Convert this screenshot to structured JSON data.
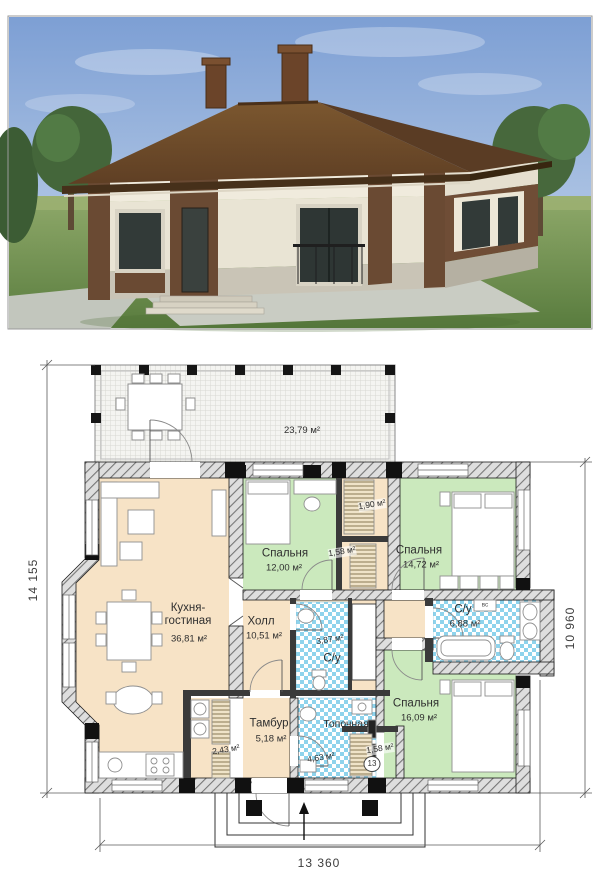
{
  "plan": {
    "terrace": {
      "area": "23,79 м²"
    },
    "rooms": {
      "kitchen": {
        "label_line1": "Кухня-",
        "label_line2": "гостиная",
        "area": "36,81 м²"
      },
      "hall": {
        "label": "Холл",
        "area": "10,51 м²"
      },
      "bedroom1": {
        "label": "Спальня",
        "area": "12,00 м²"
      },
      "bedroom2": {
        "label": "Спальня",
        "area": "14,72 м²"
      },
      "bedroom3": {
        "label": "Спальня",
        "area": "16,09 м²"
      },
      "bathroom_main": {
        "label": "С/у",
        "area": "6,88 м²"
      },
      "bathroom_small": {
        "label": "С/у",
        "area": "3,87 м²"
      },
      "tambour": {
        "label": "Тамбур",
        "area": "5,18 м²"
      },
      "boiler": {
        "label": "Топочная",
        "area": "4,63 м²"
      },
      "pantry": {
        "area": "2,43 м²"
      },
      "wardrobe1": {
        "area": "1,90 м²"
      },
      "wardrobe2": {
        "area": "1,58 м²"
      },
      "wardrobe3": {
        "area": "1,58 м²"
      }
    },
    "marks": {
      "door": "13",
      "water_heater": "вс"
    },
    "dimensions": {
      "left": "14 155",
      "right": "10 960",
      "bottom": "13 360"
    }
  },
  "colors": {
    "living": "#f7e3c6",
    "bedroom": "#cbe9bd",
    "wet": "#8ed3ec",
    "roof": "#6e4a2c",
    "wall_brick": "#e9e4d4",
    "wall_brown": "#6a4a33"
  }
}
